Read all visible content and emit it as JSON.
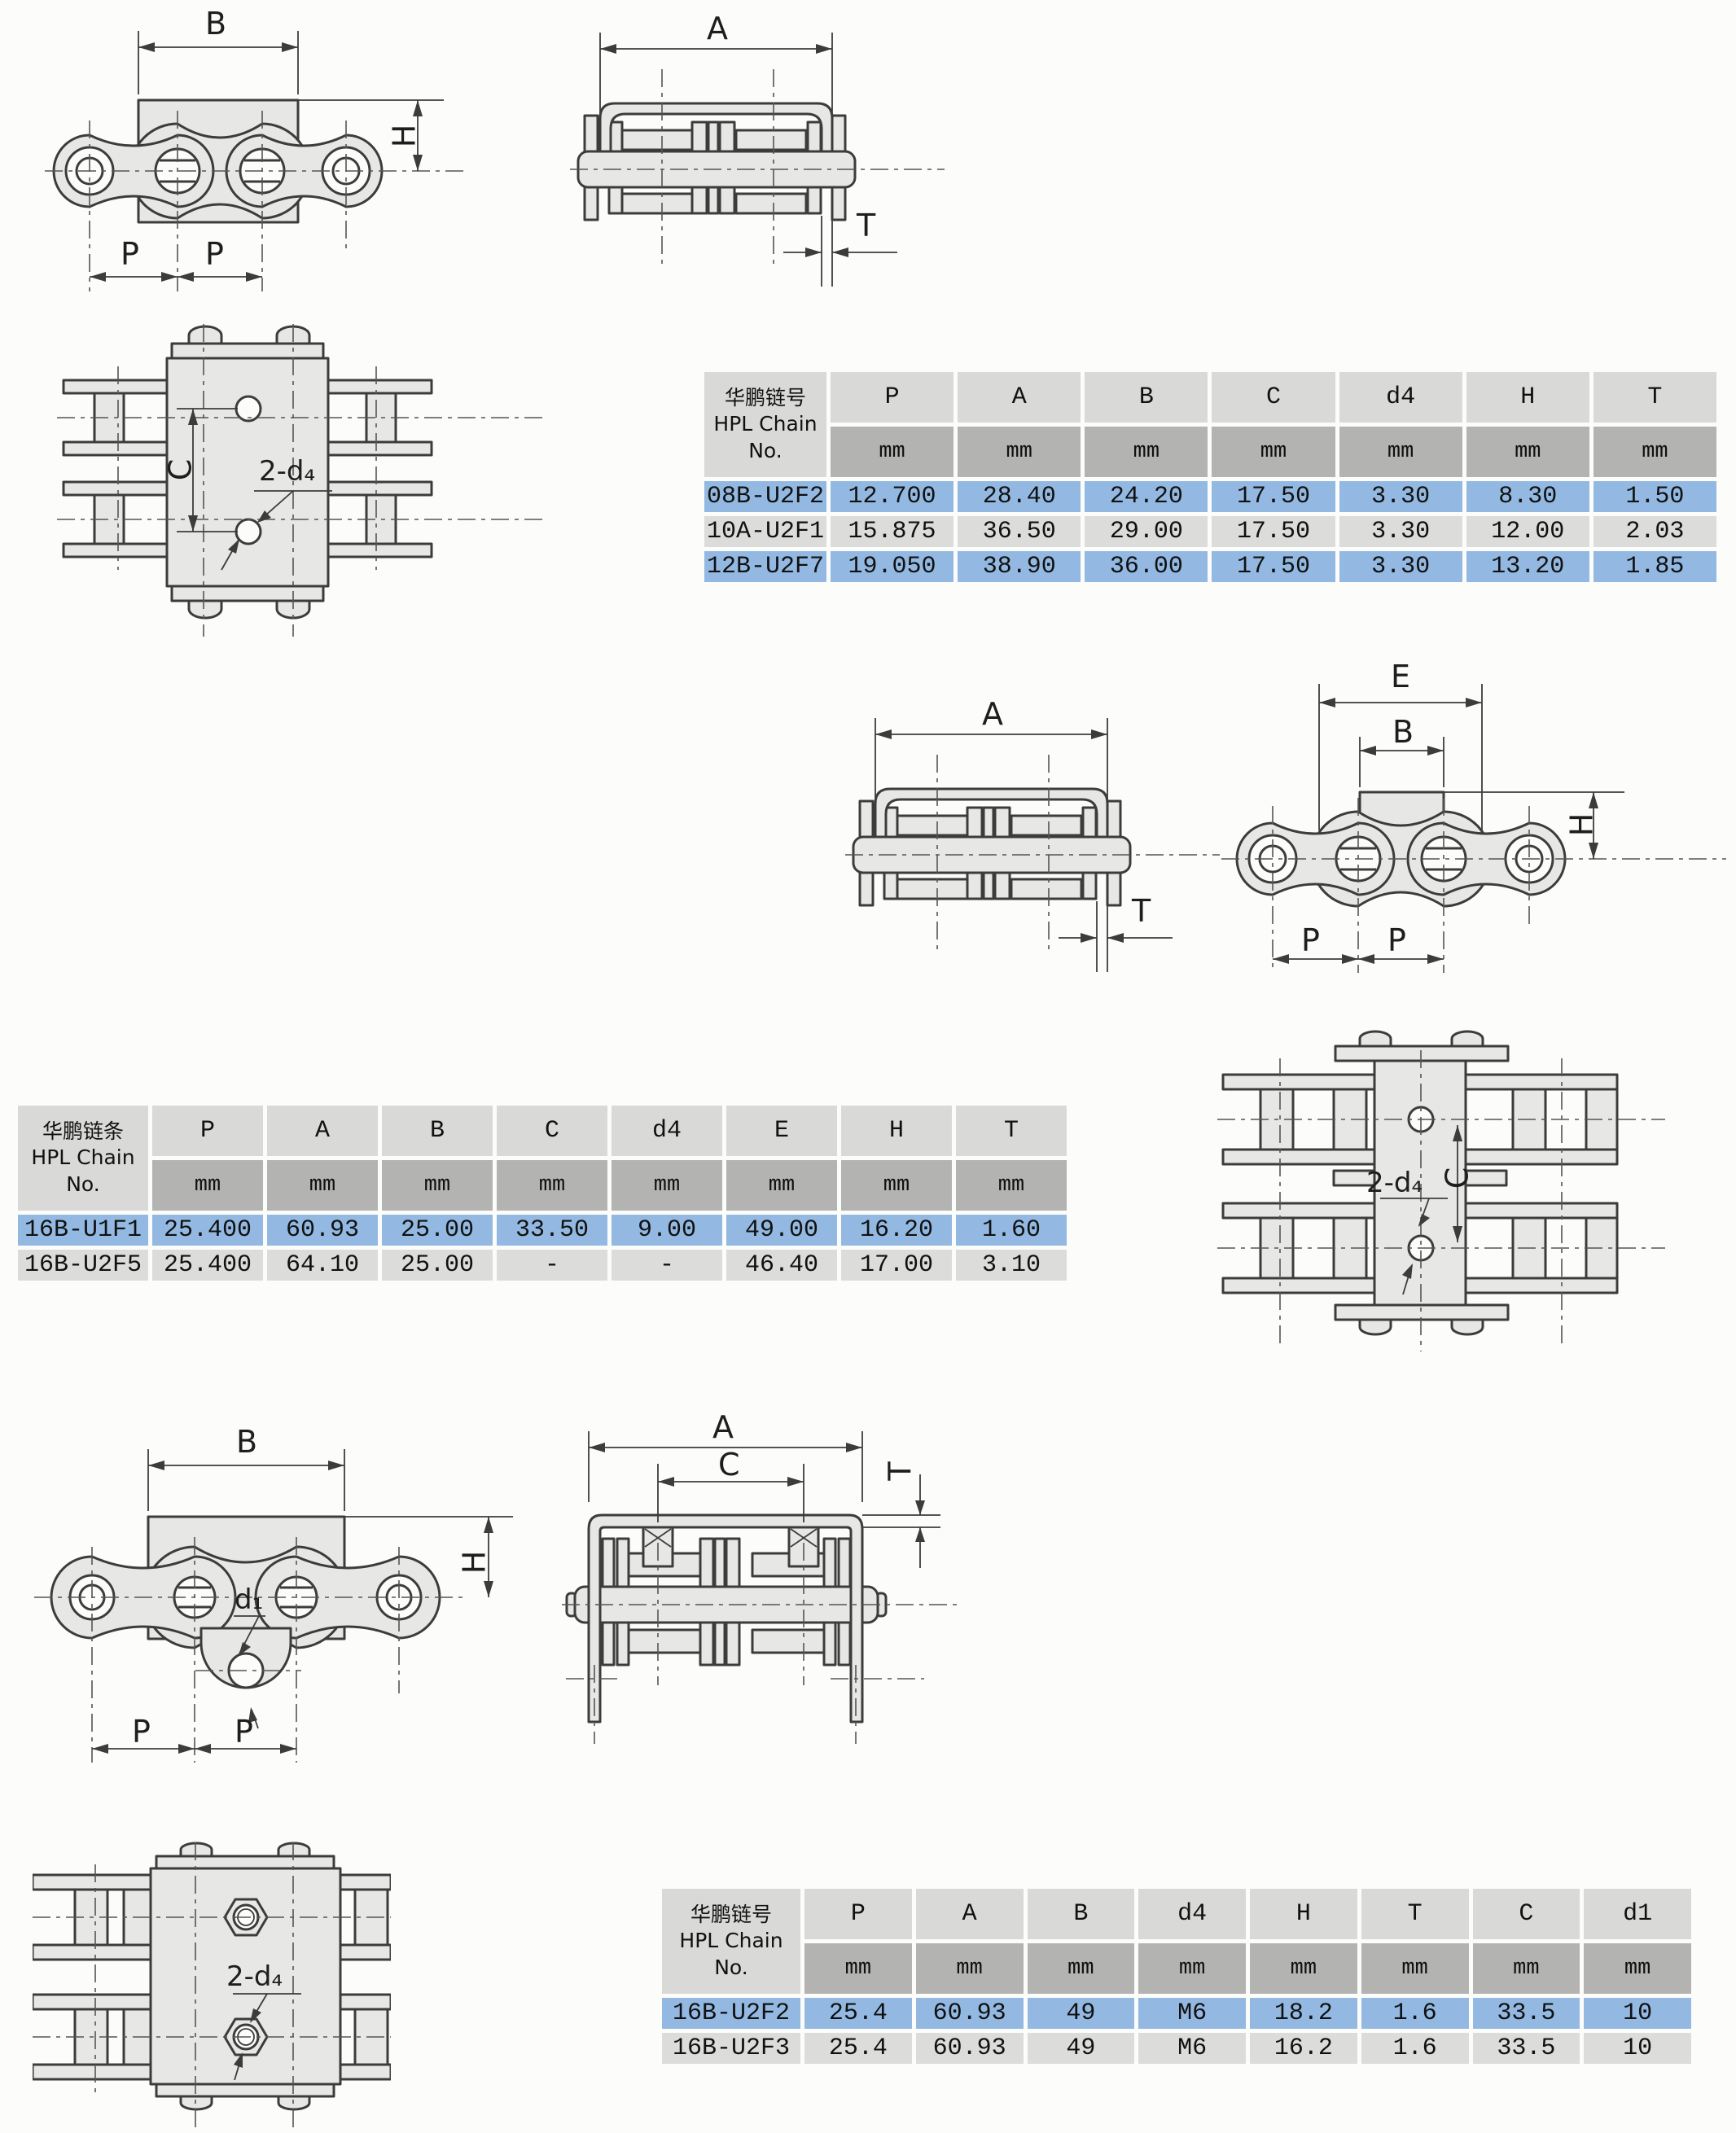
{
  "dims": {
    "P": "P",
    "A": "A",
    "B": "B",
    "C": "C",
    "E": "E",
    "H": "H",
    "T": "T",
    "d4_callout": "2-d₄",
    "d1_callout": "d₁"
  },
  "tables": {
    "t1": {
      "corner": [
        "华鹏链号",
        "HPL Chain",
        "No."
      ],
      "columns": [
        "P",
        "A",
        "B",
        "C",
        "d4",
        "H",
        "T"
      ],
      "unit": "mm",
      "rows": [
        {
          "name": "08B-U2F2",
          "values": [
            "12.700",
            "28.40",
            "24.20",
            "17.50",
            "3.30",
            "8.30",
            "1.50"
          ],
          "hl": true
        },
        {
          "name": "10A-U2F1",
          "values": [
            "15.875",
            "36.50",
            "29.00",
            "17.50",
            "3.30",
            "12.00",
            "2.03"
          ],
          "hl": false
        },
        {
          "name": "12B-U2F7",
          "values": [
            "19.050",
            "38.90",
            "36.00",
            "17.50",
            "3.30",
            "13.20",
            "1.85"
          ],
          "hl": true
        }
      ]
    },
    "t2": {
      "corner": [
        "华鹏链条",
        "HPL Chain",
        "No."
      ],
      "columns": [
        "P",
        "A",
        "B",
        "C",
        "d4",
        "E",
        "H",
        "T"
      ],
      "unit": "mm",
      "rows": [
        {
          "name": "16B-U1F1",
          "values": [
            "25.400",
            "60.93",
            "25.00",
            "33.50",
            "9.00",
            "49.00",
            "16.20",
            "1.60"
          ],
          "hl": true
        },
        {
          "name": "16B-U2F5",
          "values": [
            "25.400",
            "64.10",
            "25.00",
            "-",
            "-",
            "46.40",
            "17.00",
            "3.10"
          ],
          "hl": false
        }
      ]
    },
    "t3": {
      "corner": [
        "华鹏链号",
        "HPL Chain",
        "No."
      ],
      "columns": [
        "P",
        "A",
        "B",
        "d4",
        "H",
        "T",
        "C",
        "d1"
      ],
      "unit": "mm",
      "rows": [
        {
          "name": "16B-U2F2",
          "values": [
            "25.4",
            "60.93",
            "49",
            "M6",
            "18.2",
            "1.6",
            "33.5",
            "10"
          ],
          "hl": true
        },
        {
          "name": "16B-U2F3",
          "values": [
            "25.4",
            "60.93",
            "49",
            "M6",
            "16.2",
            "1.6",
            "33.5",
            "10"
          ],
          "hl": false
        }
      ]
    }
  }
}
